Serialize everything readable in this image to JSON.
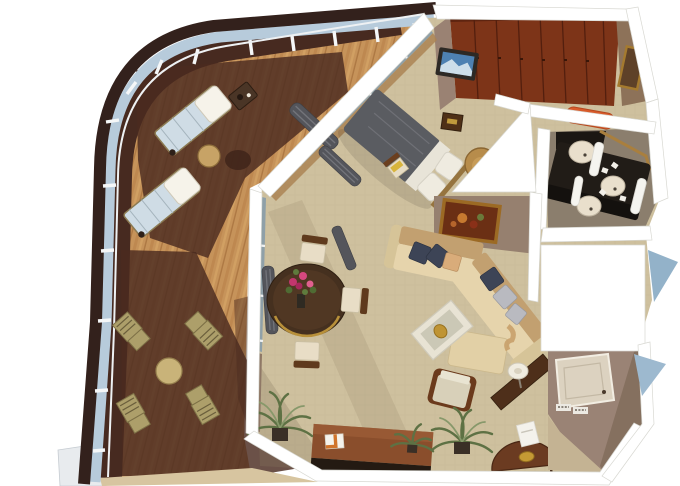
{
  "scene": {
    "description": "3D isometric cutaway floor plan of a cruise-ship penthouse suite: large curved teak veranda with sun loungers and folding chairs, living and dining room, bedroom with wardrobe wall and TV, dark double-vanity bathroom with orange bench, guest toilet and entry hall",
    "rooms": [
      "veranda",
      "living-room",
      "dining-area",
      "bedroom",
      "main-bathroom",
      "guest-toilet",
      "entry-hall"
    ],
    "furniture": {
      "veranda": [
        "sun-lounger",
        "sun-lounger",
        "drinks-table",
        "tray-table",
        "folding-chair",
        "folding-chair",
        "folding-chair",
        "folding-chair",
        "round-table"
      ],
      "living_room": [
        "sectional-sofa",
        "throw-pillows",
        "coffee-table",
        "gold-bowl",
        "armchair",
        "console-table",
        "table-lamp",
        "writing-desk",
        "open-book",
        "potted-palm",
        "potted-palm",
        "wall-painting",
        "half-round-table",
        "gold-plate",
        "white-card",
        "dining-table",
        "flower-bouquet",
        "dining-chair",
        "dining-chair",
        "dining-chair",
        "curtains"
      ],
      "bedroom": [
        "double-bed",
        "pillows",
        "round-chair",
        "nightstand",
        "wardrobe-wall",
        "wall-tv",
        "vanity-chair",
        "curtains",
        "wall-mirror"
      ],
      "main_bathroom": [
        "dark-double-vanity",
        "washbasin",
        "washbasin",
        "washbasin",
        "towel-column",
        "towel-column",
        "orange-bench"
      ],
      "guest_toilet": [
        "washbasin",
        "toilet",
        "gold-towel-bar",
        "vanity-cabinet"
      ],
      "entry_hall": [
        "cabin-door",
        "air-vents",
        "accent-table"
      ]
    }
  },
  "palette": {
    "background": "#ffffff",
    "hull": "#33211c",
    "railing_glass": "#b7cbdb",
    "deck_wood": "#c6935a",
    "deck_shadow": "#4a2b20",
    "wall_white": "#ffffff",
    "carpet": "#cec09e",
    "bath_floor": "#8b7e6d",
    "wardrobe_wood": "#7d3418",
    "bed_duvet": "#5a5c61",
    "sofa_seat": "#e6d4ac",
    "sofa_back": "#c2a070",
    "pillow_navy": "#3d4456",
    "accent_orange": "#d85b2b",
    "vanity_black": "#211c17",
    "gold": "#bf9434",
    "plant_green": "#5e7144",
    "glass_wedge": "#93b2c9",
    "tv_screen": "#4e81b2"
  }
}
